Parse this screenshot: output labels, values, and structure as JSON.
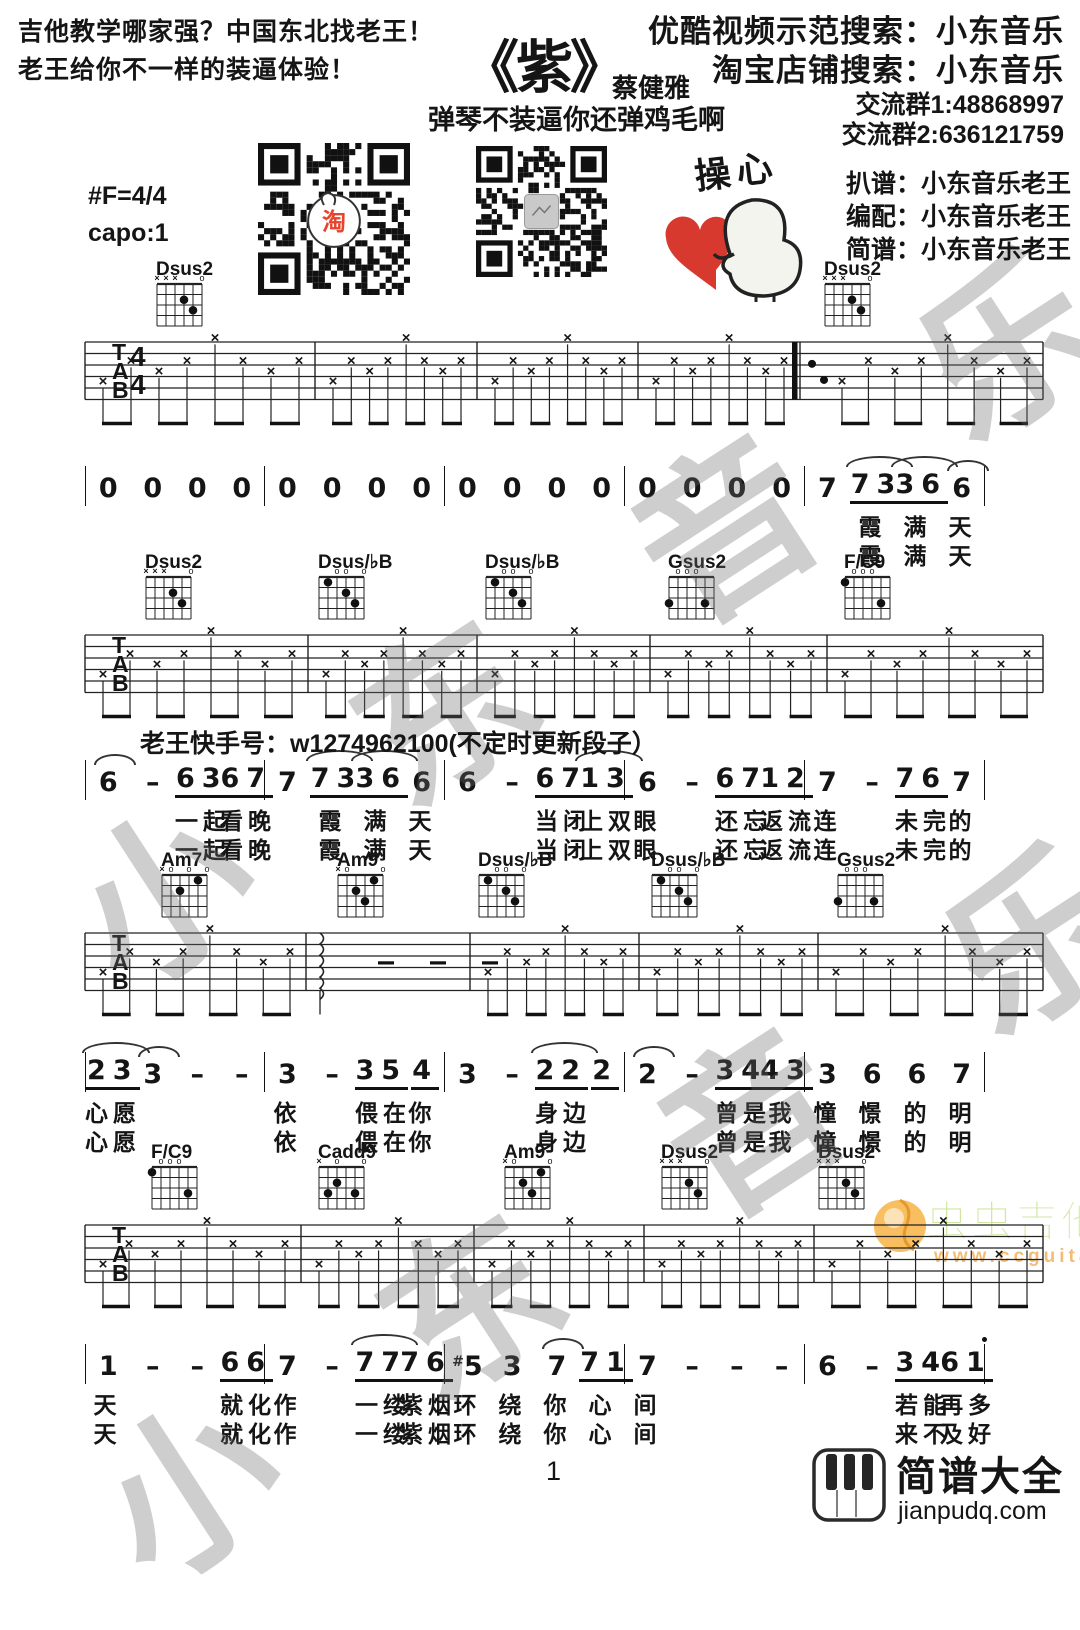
{
  "header": {
    "slogan_line1": "吉他教学哪家强？中国东北找老王！",
    "slogan_line2": "老王给你不一样的装逼体验！",
    "title": "《紫》",
    "artist": "蔡健雅",
    "subtitle": "弹琴不装逼你还弹鸡毛啊",
    "search_youku": "优酷视频示范搜索：小东音乐",
    "search_taobao": "淘宝店铺搜索：小东音乐",
    "group1": "交流群1:48868997",
    "group2": "交流群2:636121759",
    "credit_tab": "扒谱：小东音乐老王",
    "credit_arrange": "编配：小东音乐老王",
    "credit_jianpu": "简谱：小东音乐老王",
    "key": "#F=4/4",
    "capo": "capo:1",
    "cartoon_caption": "操心"
  },
  "kuaishou_note": "老王快手号：w1274962100(不定时更新段子）",
  "watermark_text": "小东音乐",
  "page_number": "1",
  "footer_logo": {
    "name": "简谱大全",
    "domain": "jianpudq.com"
  },
  "ccguitar_logo": {
    "name": "虫虫吉他",
    "url": "www.ccguitar.cn"
  },
  "colors": {
    "ink": "#151515",
    "taobao_red": "#e8432d",
    "heart_red": "#d7392f",
    "cc_green": "#cfe6a0",
    "cc_orange": "#f5a829"
  },
  "tab": {
    "clef_letters": [
      "T",
      "A",
      "B"
    ],
    "time_signature": [
      "4",
      "4"
    ],
    "strum_symbol": "×",
    "systems": [
      {
        "top": 342,
        "bars": [
          85,
          315,
          477,
          638,
          800,
          1043
        ],
        "double_bar": 800,
        "time_sig": true,
        "chords": [
          {
            "name": "Dsus2",
            "x": 155
          },
          {
            "name": "Dsus2",
            "x": 823
          }
        ],
        "specials": {
          "4": "dots"
        }
      },
      {
        "top": 635,
        "bars": [
          85,
          308,
          477,
          650,
          827,
          1043
        ],
        "chords": [
          {
            "name": "Dsus2",
            "x": 144
          },
          {
            "name": "Dsus/♭B",
            "x": 317
          },
          {
            "name": "Dsus/♭B",
            "x": 484
          },
          {
            "name": "Gsus2",
            "x": 667
          },
          {
            "name": "F/C9",
            "x": 843
          }
        ]
      },
      {
        "top": 933,
        "bars": [
          85,
          306,
          470,
          639,
          818,
          1043
        ],
        "chords": [
          {
            "name": "Am7",
            "x": 160
          },
          {
            "name": "Am9",
            "x": 336
          },
          {
            "name": "Dsus/♭B",
            "x": 477
          },
          {
            "name": "Dsus/♭B",
            "x": 650
          },
          {
            "name": "Gsus2",
            "x": 836
          }
        ],
        "specials": {
          "1": "rest"
        }
      },
      {
        "top": 1225,
        "bars": [
          85,
          301,
          474,
          644,
          814,
          1043
        ],
        "chords": [
          {
            "name": "F/C9",
            "x": 150
          },
          {
            "name": "Cadd9",
            "x": 317
          },
          {
            "name": "Am9",
            "x": 503
          },
          {
            "name": "Dsus2",
            "x": 660
          },
          {
            "name": "Dsus2",
            "x": 817
          }
        ]
      }
    ],
    "chord_shapes": {
      "Dsus2": {
        "mutes": [
          1,
          2,
          3
        ],
        "opens": [
          6
        ],
        "dots": [
          [
            4,
            2
          ],
          [
            5,
            3
          ]
        ]
      },
      "Dsus/♭B": {
        "opens": [
          3,
          4,
          6
        ],
        "dots": [
          [
            2,
            1
          ],
          [
            4,
            2
          ],
          [
            5,
            3
          ]
        ]
      },
      "Gsus2": {
        "opens": [
          2,
          3,
          4
        ],
        "dots": [
          [
            1,
            3
          ],
          [
            5,
            3
          ]
        ]
      },
      "F/C9": {
        "opens": [
          2,
          3,
          4
        ],
        "dots": [
          [
            1,
            1
          ],
          [
            5,
            3
          ]
        ]
      },
      "Am7": {
        "mutes": [
          1
        ],
        "opens": [
          2,
          4,
          6
        ],
        "dots": [
          [
            5,
            1
          ],
          [
            3,
            2
          ]
        ]
      },
      "Am9": {
        "mutes": [
          1
        ],
        "opens": [
          2,
          6
        ],
        "dots": [
          [
            5,
            1
          ],
          [
            3,
            2
          ],
          [
            4,
            3
          ]
        ]
      },
      "Cadd9": {
        "mutes": [
          1
        ],
        "opens": [
          3,
          6
        ],
        "dots": [
          [
            3,
            2
          ],
          [
            2,
            3
          ],
          [
            5,
            3
          ]
        ]
      }
    }
  },
  "jianpu": {
    "lines": [
      {
        "top": 466,
        "measures": [
          [
            {
              "t": "0"
            },
            {
              "t": "0"
            },
            {
              "t": "0"
            },
            {
              "t": "0"
            }
          ],
          [
            {
              "t": "0"
            },
            {
              "t": "0"
            },
            {
              "t": "0"
            },
            {
              "t": "0"
            }
          ],
          [
            {
              "t": "0"
            },
            {
              "t": "0"
            },
            {
              "t": "0"
            },
            {
              "t": "0"
            }
          ],
          [
            {
              "t": "0"
            },
            {
              "t": "0"
            },
            {
              "t": "0"
            },
            {
              "t": "0"
            }
          ],
          [
            {
              "t": "7"
            },
            {
              "t": "73",
              "u": 1,
              "arc": 1,
              "l": "霞",
              "l2": "霞"
            },
            {
              "t": "36",
              "u": 1,
              "arc": 1,
              "l": "满",
              "l2": "满"
            },
            {
              "t": "6",
              "arc": 1,
              "l": "天",
              "l2": "天"
            }
          ]
        ]
      },
      {
        "top": 760,
        "measures": [
          [
            {
              "t": "6",
              "arc": 1
            },
            {
              "t": "-"
            },
            {
              "t": "63",
              "u": 1,
              "l": "一起",
              "l2": "一起"
            },
            {
              "t": "67",
              "u": 1,
              "l": "看晚",
              "l2": "看晚"
            }
          ],
          [
            {
              "t": "7"
            },
            {
              "t": "73",
              "u": 1,
              "arc": 1,
              "l": "霞",
              "l2": "霞"
            },
            {
              "t": "36",
              "u": 1,
              "arc": 1,
              "l": "满",
              "l2": "满"
            },
            {
              "t": "6",
              "l": "天",
              "l2": "天"
            }
          ],
          [
            {
              "t": "6"
            },
            {
              "t": "-"
            },
            {
              "t": "67",
              "u": 1,
              "l": "当闭",
              "l2": "当闭"
            },
            {
              "t": "13",
              "u": 1,
              "arc": 1,
              "l": "上双",
              "l2": "上双"
            }
          ],
          [
            {
              "t": "6",
              "l": "眼",
              "l2": "眼"
            },
            {
              "t": "-"
            },
            {
              "t": "67",
              "u": 1,
              "l": "还忘",
              "l2": "还忘"
            },
            {
              "t": "12",
              "u": 1,
              "l": "返流",
              "l2": "返流"
            }
          ],
          [
            {
              "t": "7",
              "l": "连",
              "l2": "连"
            },
            {
              "t": "-"
            },
            {
              "t": "76",
              "u": 1,
              "l": "未完",
              "l2": "未完"
            },
            {
              "t": "7",
              "l": "的",
              "l2": "的"
            }
          ]
        ]
      },
      {
        "top": 1052,
        "measures": [
          [
            {
              "t": "23",
              "u": 1,
              "arc": 1,
              "l": "心愿",
              "l2": "心愿"
            },
            {
              "t": "3",
              "arc": 1
            },
            {
              "t": "-"
            },
            {
              "t": "-"
            }
          ],
          [
            {
              "t": "3",
              "l": "依",
              "l2": "依"
            },
            {
              "t": "-"
            },
            {
              "t": "35",
              "u": 1,
              "l": "偎在",
              "l2": "偎在"
            },
            {
              "t": "4",
              "u": 1,
              "l": "你",
              "l2": "你"
            }
          ],
          [
            {
              "t": "3"
            },
            {
              "t": "-"
            },
            {
              "t": "22",
              "u": 1,
              "arc": 1,
              "l": "身边",
              "l2": "身边"
            },
            {
              "t": "2",
              "u": 1
            }
          ],
          [
            {
              "t": "2",
              "arc": 1
            },
            {
              "t": "-"
            },
            {
              "t": "34",
              "u": 1,
              "l": "曾是",
              "l2": "曾是"
            },
            {
              "t": "43",
              "u": 1,
              "l": "我",
              "l2": "我"
            }
          ],
          [
            {
              "t": "3",
              "l": "憧",
              "l2": "憧"
            },
            {
              "t": "6",
              "l": "憬",
              "l2": "憬"
            },
            {
              "t": "6",
              "l": "的",
              "l2": "的"
            },
            {
              "t": "7",
              "l": "明",
              "l2": "明"
            }
          ]
        ]
      },
      {
        "top": 1344,
        "measures": [
          [
            {
              "t": "1",
              "l": "天",
              "l2": "天"
            },
            {
              "t": "-"
            },
            {
              "t": "-"
            },
            {
              "t": "66",
              "u": 1,
              "l": "就化",
              "l2": "就化"
            }
          ],
          [
            {
              "t": "7",
              "l": "作",
              "l2": "作"
            },
            {
              "t": "-"
            },
            {
              "t": "77",
              "u": 1,
              "arc": 1,
              "l": "一缕",
              "l2": "一缕"
            },
            {
              "t": "76",
              "u": 1,
              "l": "紫烟",
              "l2": "紫烟"
            }
          ],
          [
            {
              "t": "5",
              "sharp": 1,
              "l": "环",
              "l2": "环"
            },
            {
              "t": "3",
              "l": "绕",
              "l2": "绕"
            },
            {
              "t": "7",
              "arc": 1,
              "l": "你",
              "l2": "你"
            },
            {
              "t": "71",
              "u": 1,
              "l": "心",
              "l2": "心"
            }
          ],
          [
            {
              "t": "7",
              "l": "间",
              "l2": "间"
            },
            {
              "t": "-"
            },
            {
              "t": "-"
            },
            {
              "t": "-"
            }
          ],
          [
            {
              "t": "6"
            },
            {
              "t": "-"
            },
            {
              "t": "34",
              "u": 1,
              "l": "若能",
              "l2": "来不"
            },
            {
              "t": "61",
              "u": 1,
              "hi": 1,
              "l": "再多",
              "l2": "及好"
            }
          ]
        ]
      }
    ]
  }
}
